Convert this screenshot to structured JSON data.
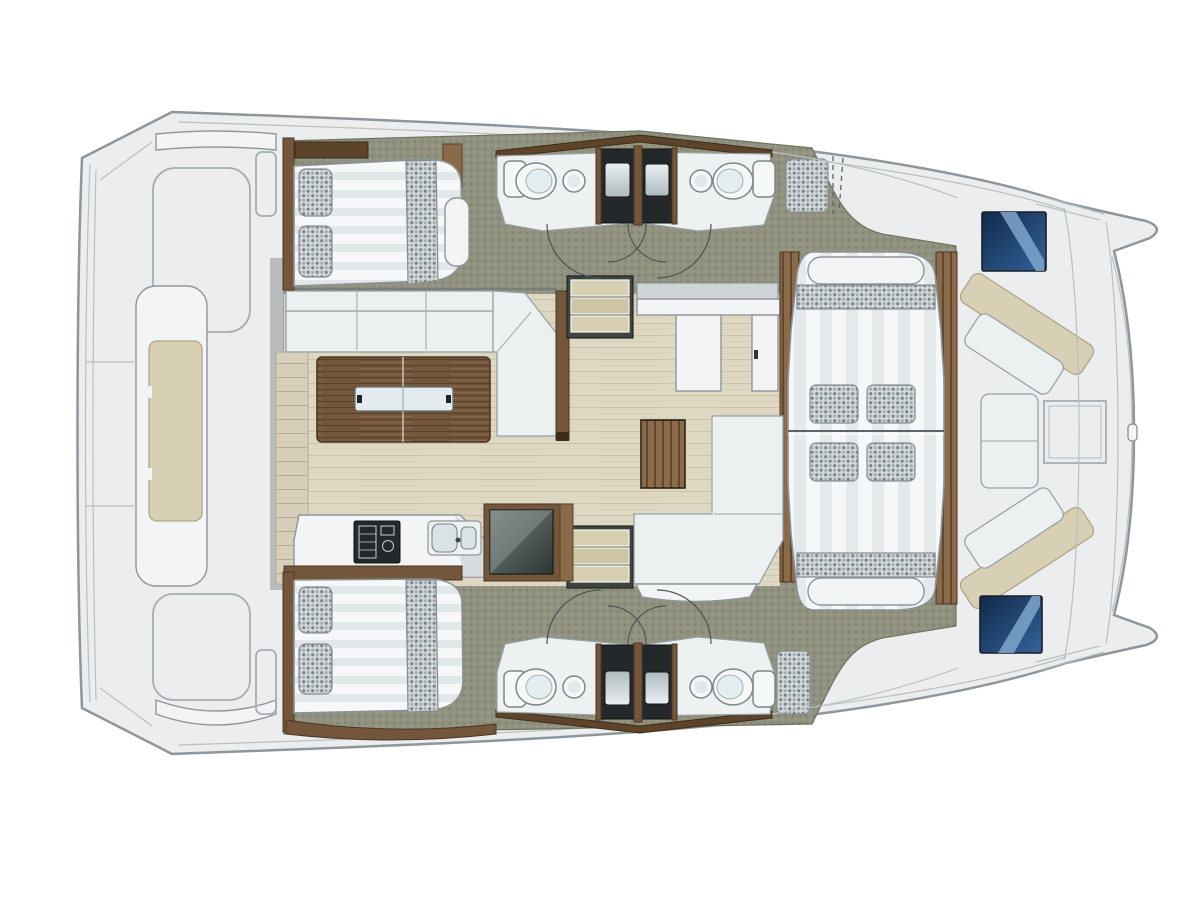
{
  "meta": {
    "title": "Catamaran yacht deck floor plan",
    "canvas_width": 1200,
    "canvas_height": 900,
    "background": "#ffffff"
  },
  "palette": {
    "deck": "#ebedee",
    "deckLine": "#8f969b",
    "carpet": "#90917f",
    "carpetDot": "#7d7e6c",
    "carpetDot2": "#9d9e8c",
    "floor": "#ded8c2",
    "floorLine": "#cbc4a9",
    "plank": "#d6d0ba",
    "plankLine": "#b3ac93",
    "white": "#f2f4f5",
    "cushion": "#edf0f1",
    "cushionLine": "#98a1a6",
    "stripe": "#e2e7ea",
    "stripeSoft": "#e4e9ec",
    "stripeBase": "#f5f7f8",
    "checkerBase": "#d3d8da",
    "checkerDot": "#798287",
    "checkerDot2": "#a5acb0",
    "beige": "#d8d0b4",
    "beigeLine": "#afa687",
    "woodDark": "#5d432a",
    "woodMid": "#74563a",
    "woodLight": "#8a6a48",
    "stair": "#d7d0b2",
    "stair2": "#cdc5a4",
    "darkUnit": "#24282a",
    "tray1": "#e8f0f2",
    "tray2": "#aebabd",
    "basin": "#d9e3e5",
    "porcelain": "#f6f8f8",
    "glass": "#e3ebee",
    "blueDark": "#11294a",
    "blueMid": "#33639a",
    "blueLight": "#7fa6cb",
    "applianceDark": "#2c3634",
    "applianceLight": "#76827d"
  },
  "regions": {
    "hull": "Catamaran twin-hull deck outline with bow tips to the right",
    "aft_deck": "Aft platform deck with central sun pad",
    "aft_sunpad": "Aft sun pad cushion",
    "port_cabin": "Port aft double berth cabin",
    "port_heads": "Port hull head compartments with shower stalls",
    "saloon": "Main deck saloon",
    "saloon_sofa": "L-shaped saloon sofa",
    "saloon_table": "Folding wooden saloon table",
    "galley": "Galley with stove, double sink and refrigerator",
    "stairs_port": "Companionway steps down to port hull",
    "stairs_starboard": "Companionway steps down to starboard hull",
    "forward_counter": "Forward galley counter unit",
    "coffee_table": "Slatted wooden side table",
    "chaise": "L-shaped lounge seat",
    "starboard_cabin": "Starboard aft double berth cabin",
    "starboard_heads": "Starboard hull head compartments with shower stalls",
    "forward_lounge": "Forward lounge double sunbed with pillows",
    "fore_cockpit": "Forward cockpit bench seating with table",
    "deck_hatch_port": "Port deck hatch window",
    "deck_hatch_starboard": "Starboard deck hatch window"
  }
}
